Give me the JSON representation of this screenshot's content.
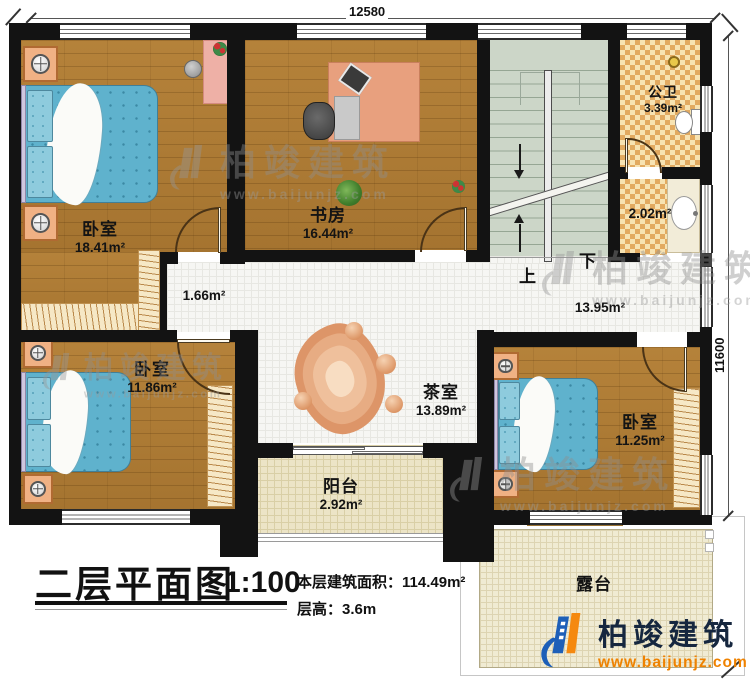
{
  "title_block": {
    "title": "二层平面图",
    "scale": "1:100",
    "area_label": "本层建筑面积：",
    "area_value": "114.49m²",
    "height_label": "层高：",
    "height_value": "3.6m"
  },
  "dimensions": {
    "top": "12580",
    "right": "11600"
  },
  "rooms": {
    "bedroom1": {
      "name": "卧室",
      "area": "18.41m²"
    },
    "study": {
      "name": "书房",
      "area": "16.44m²"
    },
    "bathroom": {
      "name": "公卫",
      "area": "3.39m²"
    },
    "wash_area": {
      "area": "2.02m²"
    },
    "hallway": {
      "area": "1.66m²"
    },
    "corridor": {
      "area": "13.95m²"
    },
    "tearoom": {
      "name": "茶室",
      "area": "13.89m²"
    },
    "bedroom2": {
      "name": "卧室",
      "area": "11.86m²"
    },
    "bedroom3": {
      "name": "卧室",
      "area": "11.25m²"
    },
    "balcony": {
      "name": "阳台",
      "area": "2.92m²"
    },
    "terrace": {
      "name": "露台"
    }
  },
  "stairs": {
    "up_label": "上",
    "down_label": "下"
  },
  "branding": {
    "company": "柏竣建筑",
    "website": "www.baijunjz.com"
  },
  "watermark": {
    "company": "柏竣建筑",
    "website": "www.baijunjz.com"
  },
  "colors": {
    "wall": "#131313",
    "wood_floor": "#ab7a33",
    "bed_blue": "#5fb2cd",
    "stair_green": "#ccd6c8",
    "bath_tile": "#e2aa60",
    "logo_blue": "#1d5fb8",
    "logo_orange": "#f5890f",
    "watermark_gray": "#979797"
  }
}
